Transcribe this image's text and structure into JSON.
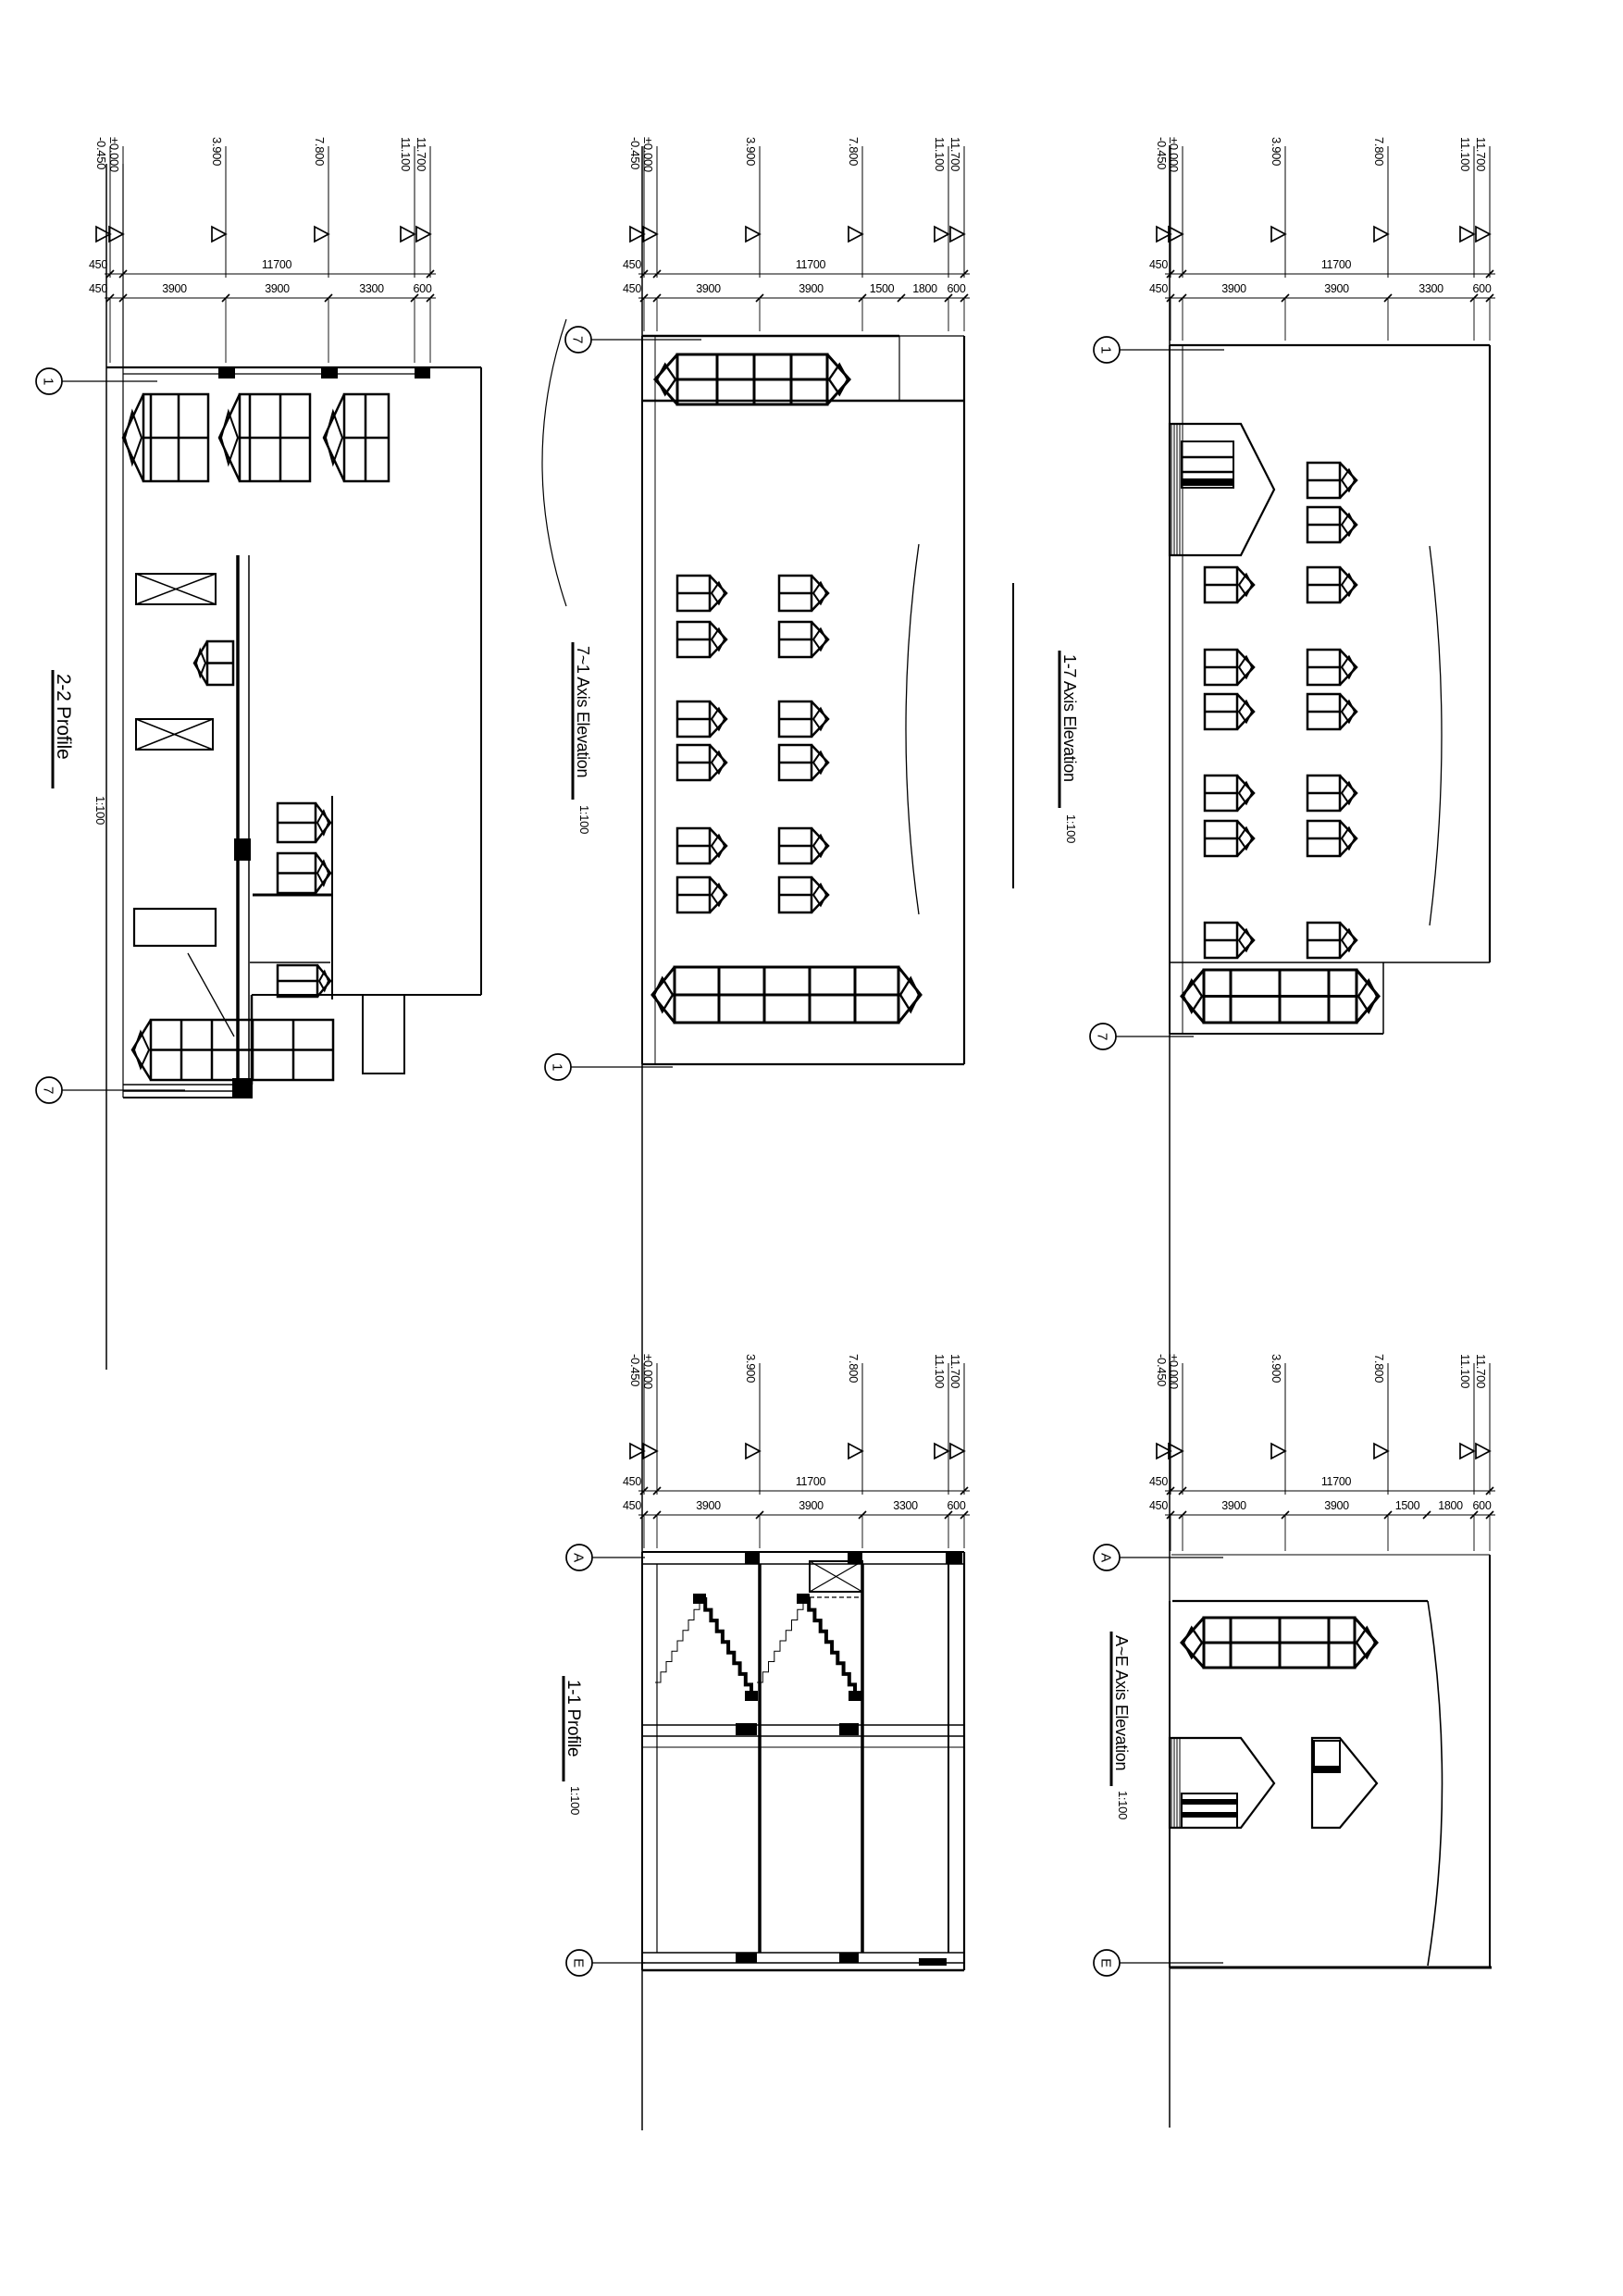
{
  "sheet": {
    "background": "#ffffff",
    "line_color": "#000000"
  },
  "drawings": [
    {
      "id": "2-2-profile",
      "title": "2-2 Profile",
      "scale": "1:100",
      "elevation_marks": [
        "-0.450",
        "±0.000",
        "3.900",
        "7.800",
        "11.100",
        "11.700"
      ],
      "dim_outer": [
        "450",
        "11700"
      ],
      "dim_inner": [
        "450",
        "3900",
        "3900",
        "3300",
        "600"
      ],
      "axis_top": "1",
      "axis_bottom": "7"
    },
    {
      "id": "7-1-axis-elevation",
      "title": "7~1 Axis Elevation",
      "scale": "1:100",
      "elevation_marks": [
        "-0.450",
        "±0.000",
        "3.900",
        "7.800",
        "11.100",
        "11.700"
      ],
      "dim_outer": [
        "450",
        "11700"
      ],
      "dim_inner": [
        "450",
        "3900",
        "3900",
        "1500",
        "1800",
        "600"
      ],
      "axis_top": "7",
      "axis_bottom": "1"
    },
    {
      "id": "1-7-axis-elevation",
      "title": "1-7 Axis Elevation",
      "scale": "1:100",
      "elevation_marks": [
        "-0.450",
        "±0.000",
        "3.900",
        "7.800",
        "11.100",
        "11.700"
      ],
      "dim_outer": [
        "450",
        "11700"
      ],
      "dim_inner": [
        "450",
        "3900",
        "3900",
        "3300",
        "600"
      ],
      "axis_top": "1",
      "axis_bottom": "7"
    },
    {
      "id": "1-1-profile",
      "title": "1-1 Profile",
      "scale": "1:100",
      "elevation_marks": [
        "-0.450",
        "±0.000",
        "3.900",
        "7.800",
        "11.100",
        "11.700"
      ],
      "dim_outer": [
        "450",
        "11700"
      ],
      "dim_inner": [
        "450",
        "3900",
        "3900",
        "3300",
        "600"
      ],
      "axis_top": "A",
      "axis_bottom": "E"
    },
    {
      "id": "a-e-axis-elevation",
      "title": "A~E Axis Elevation",
      "scale": "1:100",
      "elevation_marks": [
        "-0.450",
        "±0.000",
        "3.900",
        "7.800",
        "11.100",
        "11.700"
      ],
      "dim_outer": [
        "450",
        "11700"
      ],
      "dim_inner": [
        "450",
        "3900",
        "3900",
        "1500",
        "1800",
        "600"
      ],
      "axis_top": "A",
      "axis_bottom": "E"
    }
  ]
}
